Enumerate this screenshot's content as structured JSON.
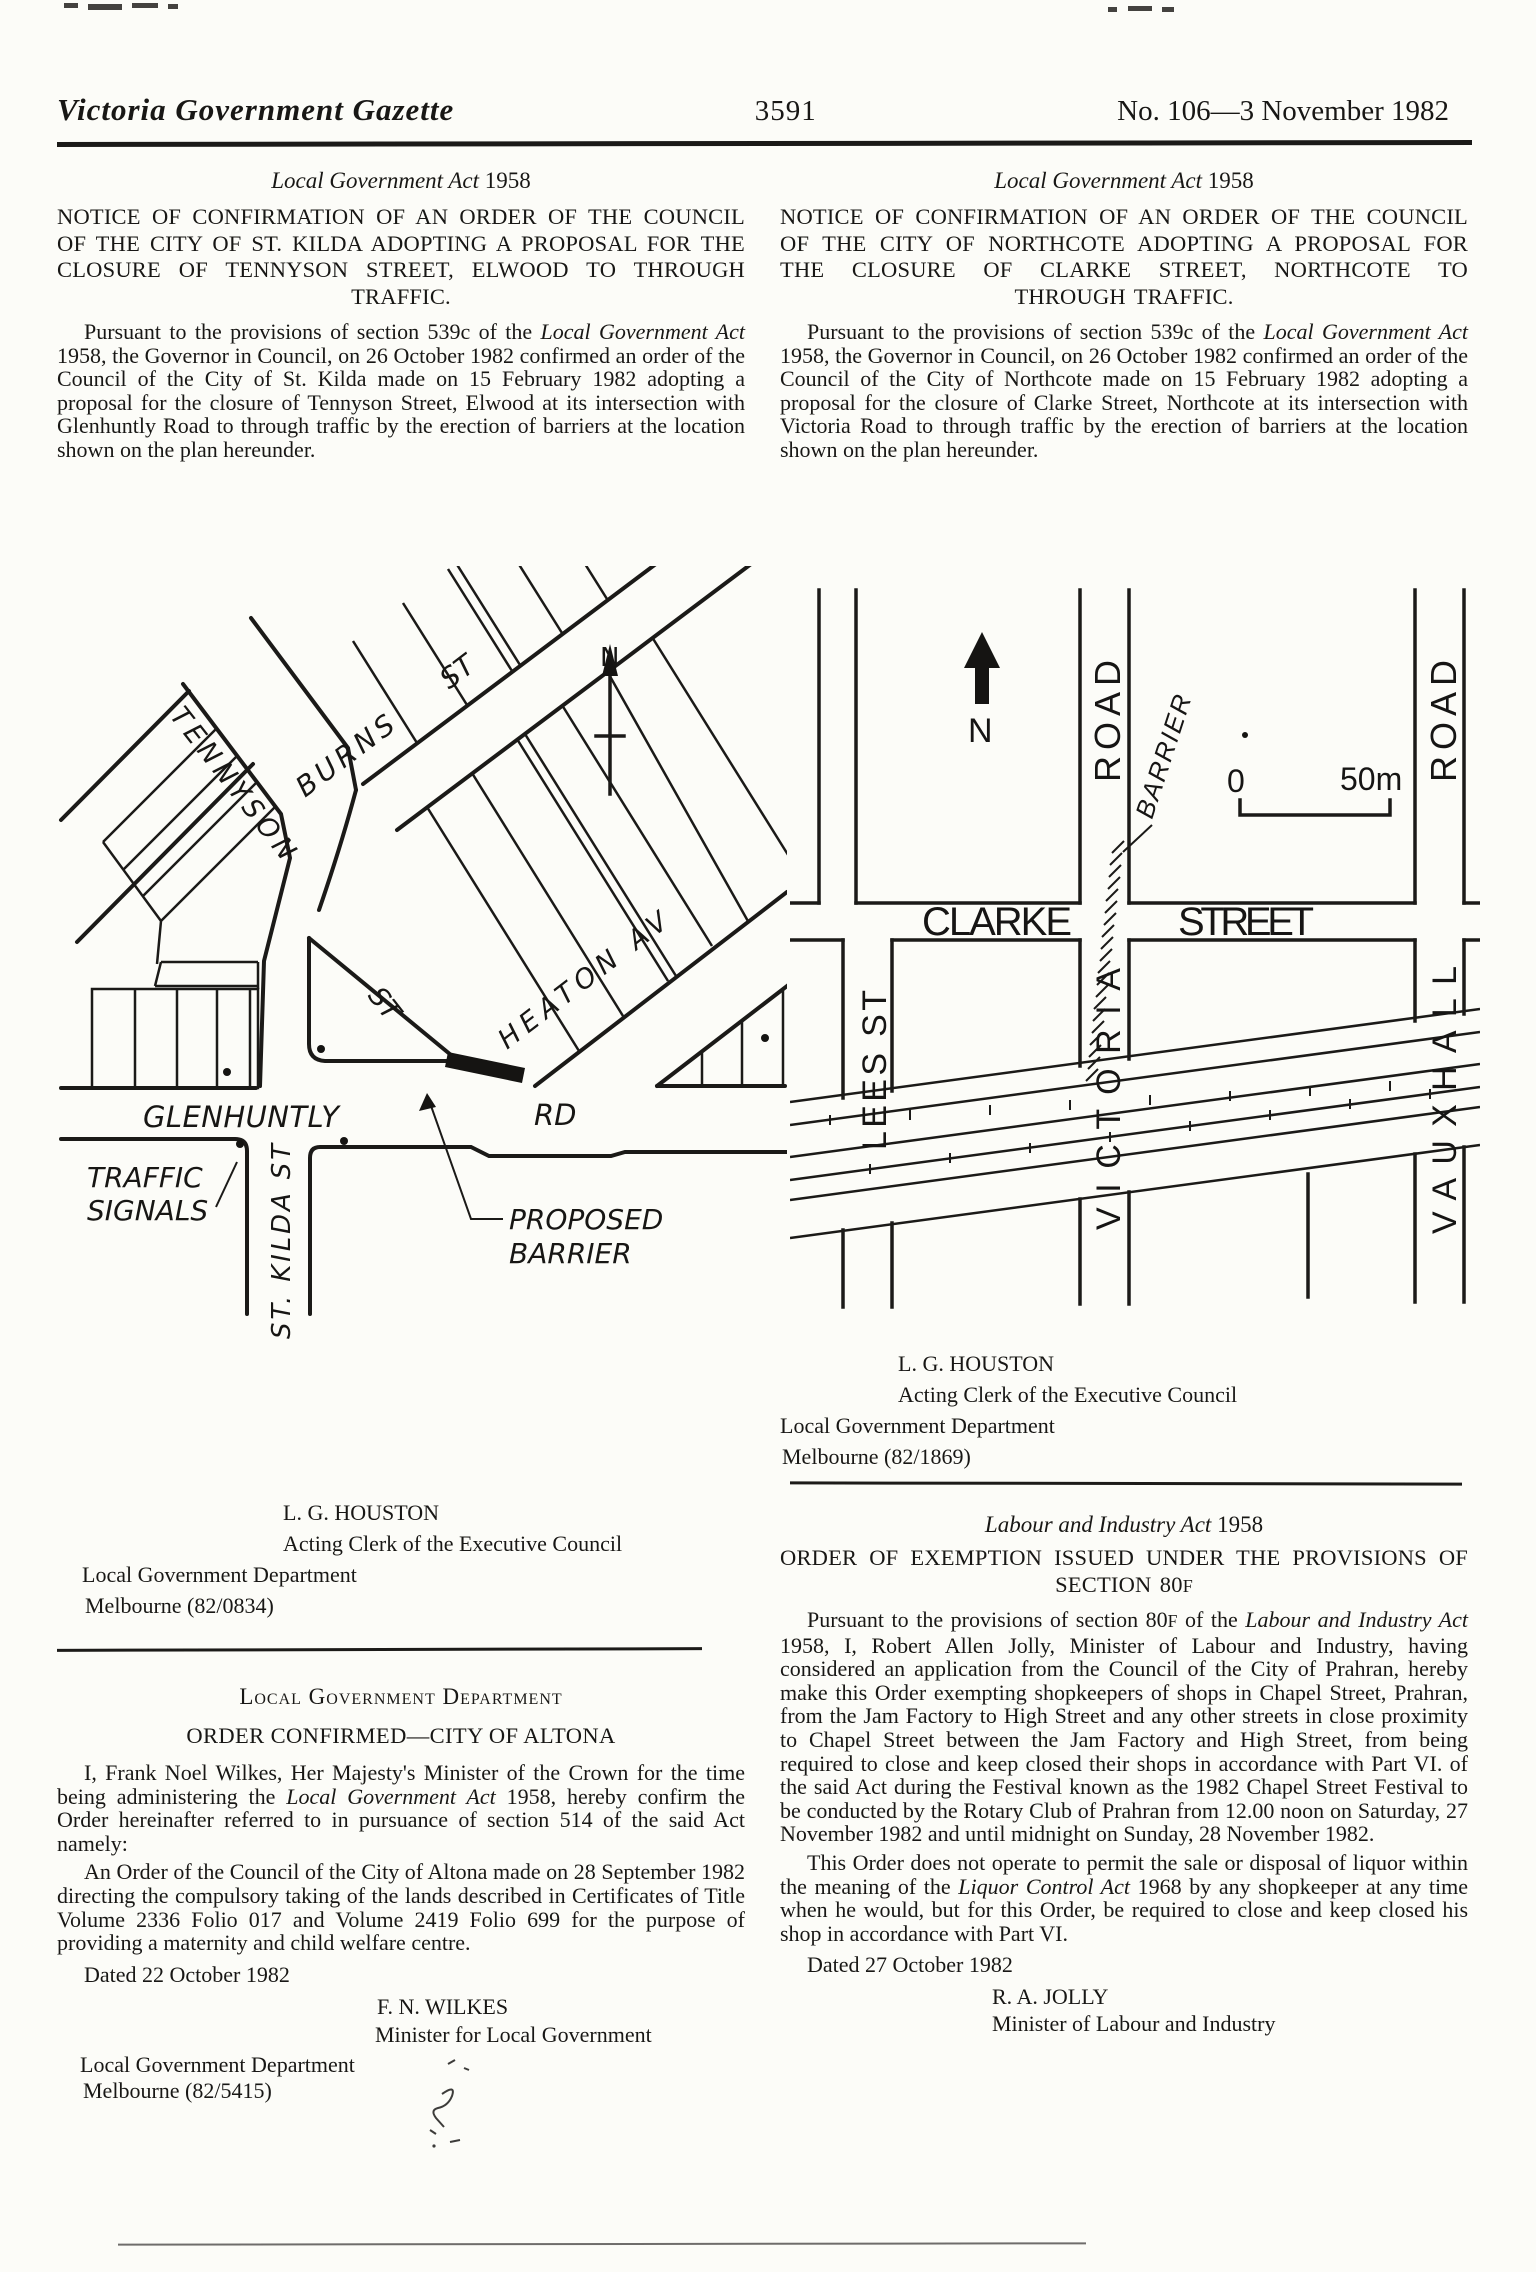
{
  "header": {
    "title": "Victoria Government Gazette",
    "page_number": "3591",
    "issue": "No. 106—3 November 1982"
  },
  "stkilda": {
    "act_name": "Local Government Act",
    "act_year": " 1958",
    "heading": "NOTICE OF CONFIRMATION OF AN ORDER OF THE COUNCIL OF THE CITY OF ST. KILDA ADOPTING A PROPOSAL FOR THE CLOSURE OF TENNYSON STREET, ELWOOD TO THROUGH TRAFFIC.",
    "para_a": "Pursuant to the provisions of section 539c of the ",
    "para_act": "Local Government Act",
    "para_b": " 1958, the Governor in Council, on 26 October 1982 confirmed an order of the Council of the City of St. Kilda made on 15 February 1982 adopting a proposal for the closure of Tennyson Street, Elwood at its intersection with Glenhuntly Road to through traffic by the erection of barriers at the location shown on the plan hereunder.",
    "signature": {
      "name": "L. G. HOUSTON",
      "title": "Acting Clerk of the Executive Council",
      "dept": "Local Government Department",
      "ref": "Melbourne (82/0834)"
    },
    "map": {
      "north": "N",
      "tennyson": "TENNYSON",
      "tennyson_st": "ST",
      "burns": "BURNS",
      "burns_st": "ST",
      "heaton": "HEATON AV",
      "glenhuntly": "GLENHUNTLY",
      "rd": "RD",
      "traffic_line1": "TRAFFIC",
      "traffic_line2": "SIGNALS",
      "st_kilda": "ST. KILDA ST",
      "proposed_line1": "PROPOSED",
      "proposed_line2": "BARRIER"
    }
  },
  "northcote": {
    "act_name": "Local Government Act",
    "act_year": " 1958",
    "heading": "NOTICE OF CONFIRMATION OF AN ORDER OF THE COUNCIL OF THE CITY OF NORTHCOTE ADOPTING A PROPOSAL FOR THE CLOSURE OF CLARKE STREET, NORTHCOTE TO THROUGH TRAFFIC.",
    "para_a": "Pursuant to the provisions of section 539c of the ",
    "para_act": "Local Government Act",
    "para_b": " 1958, the Governor in Council, on 26 October 1982 confirmed an order of the Council of the City of Northcote made on 15 February 1982 adopting a proposal for the closure of Clarke Street, Northcote at its intersection with Victoria Road to through traffic by the erection of barriers at the location shown on the plan hereunder.",
    "signature": {
      "name": "L. G. HOUSTON",
      "title": "Acting Clerk of the Executive Council",
      "dept": "Local Government Department",
      "ref": "Melbourne (82/1869)"
    },
    "map": {
      "north": "N",
      "scale_zero": "0",
      "scale_fifty": "50m",
      "road_victoria": "ROAD",
      "road_vauxhall": "ROAD",
      "barrier": "BARRIER",
      "clarke": "CLARKE",
      "street": "STREET",
      "lees": "LEES ST",
      "victoria": "VICTORIA",
      "vauxhall": "VAUXHALL"
    }
  },
  "altona": {
    "dept_heading": "Local Government Department",
    "order_heading": "ORDER CONFIRMED—CITY OF ALTONA",
    "para1_a": "I, Frank Noel Wilkes, Her Majesty's Minister of the Crown for the time being administering the ",
    "para1_act": "Local Government Act",
    "para1_b": " 1958, hereby confirm the Order hereinafter referred to in pursuance of section 514 of the said Act namely:",
    "para2": "An Order of the Council of the City of Altona made on 28 September 1982 directing the compulsory taking of the lands described in Certificates of Title Volume 2336 Folio 017 and Volume 2419 Folio 699 for the purpose of providing a maternity and child welfare centre.",
    "dated": "Dated 22 October 1982",
    "sig_name": "F. N. WILKES",
    "sig_title": "Minister for Local Government",
    "dept": "Local Government Department",
    "ref": "Melbourne (82/5415)"
  },
  "labour": {
    "act_name": "Labour and Industry Act",
    "act_year": " 1958",
    "heading_a": "ORDER OF EXEMPTION ISSUED UNDER THE PROVISIONS OF SECTION 80",
    "heading_sc": "F",
    "para1_a": "Pursuant to the provisions of section 80",
    "para1_sc": "F",
    "para1_b": " of the ",
    "para1_act": "Labour and Industry Act",
    "para1_c": " 1958, I, Robert Allen Jolly, Minister of Labour and Industry, having considered an application from the Council of the City of Prahran, hereby make this Order exempting shopkeepers of shops in Chapel Street, Prahran, from the Jam Factory to High Street and any other streets in close proximity to Chapel Street between the Jam Factory and High Street, from being required to close and keep closed their shops in accordance with Part VI. of the said Act during the Festival known as the 1982 Chapel Street Festival to be conducted by the Rotary Club of Prahran from 12.00 noon on Saturday, 27 November 1982 and until midnight on Sunday, 28 November 1982.",
    "para2_a": "This Order does not operate to permit the sale or disposal of liquor within the meaning of the ",
    "para2_act": "Liquor Control Act",
    "para2_b": " 1968 by any shopkeeper at any time when he would, but for this Order, be required to close and keep closed his shop in accordance with Part VI.",
    "dated": "Dated 27 October 1982",
    "sig_name": "R. A. JOLLY",
    "sig_title": "Minister of Labour and Industry"
  }
}
